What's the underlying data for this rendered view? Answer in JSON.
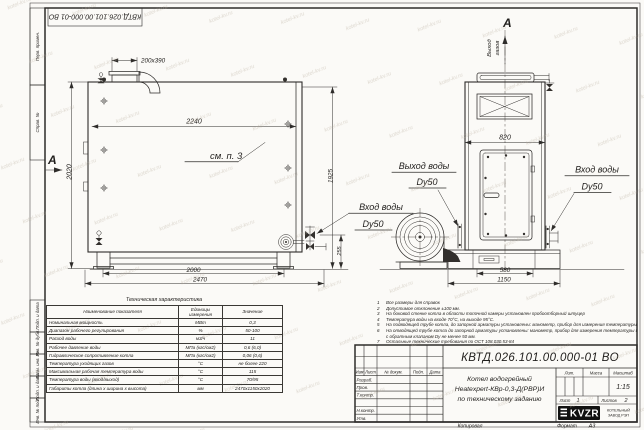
{
  "sheet": {
    "corner_stamp": "КВТД.026.101.00.000-01 ВО"
  },
  "watermark": "kotel-kv.ru",
  "margin_labels": [
    "Перв. примен.",
    "Справ. №",
    "Подп. и дата",
    "Инв. № дубл.",
    "Взам. инв. №",
    "Подп. и дата",
    "Инв. № подл."
  ],
  "drawing": {
    "left_view": {
      "section_label": "А",
      "see_note": "см. п. 3",
      "dim_flue": "200х390",
      "dim_top": "2240",
      "dim_height": "2020",
      "dim_height_right": "1925",
      "dim_fitting": "255",
      "dim_supports": "2000",
      "dim_length": "2470",
      "water_in_l1": "Вход воды",
      "water_in_l2": "Dу50"
    },
    "right_view": {
      "view_label": "А",
      "gas_l1": "Выход",
      "gas_l2": "газов",
      "dim_width": "820",
      "dim_base": "580",
      "dim_overall": "1150",
      "water_out_l1": "Выход воды",
      "water_out_l2": "Dу50",
      "water_in_l1": "Вход воды",
      "water_in_l2": "Dу50"
    }
  },
  "spec_table": {
    "title": "Техническая характеристика",
    "headers": [
      "Наименование показателя",
      "Единицы измерения",
      "Значение"
    ],
    "rows": [
      [
        "Номинальная мощность",
        "МВт",
        "0,3"
      ],
      [
        "Диапазон рабочего регулирования",
        "%",
        "50-100"
      ],
      [
        "Расход воды",
        "м3/ч",
        "11"
      ],
      [
        "Рабочее давление воды",
        "МПа (кгс/см2)",
        "0,6 (6,0)"
      ],
      [
        "Гидравлическое сопротивление котла",
        "МПа (кгс/см2)",
        "0,06 (0,6)"
      ],
      [
        "Температура уходящих газов",
        "°С",
        "не более 220"
      ],
      [
        "Максимальная рабочая температура воды",
        "°С",
        "115"
      ],
      [
        "Температура воды (вход/выход)",
        "°С",
        "70/95"
      ],
      [
        "Габариты котла (длина х ширина х высота)",
        "мм",
        "2470х1150х2020"
      ]
    ]
  },
  "notes": [
    {
      "n": "1",
      "t": "Все размеры для справок"
    },
    {
      "n": "2",
      "t": "Допустимое отклонение ±100 мм."
    },
    {
      "n": "3",
      "t": "На боковой стенке котла в области топочной камеры установлен пробоотборный штуцер"
    },
    {
      "n": "4",
      "t": "Температура воды на входе 70°С, на выходе 95°С."
    },
    {
      "n": "5",
      "t": "На подводящей трубе котла, до запорной арматуры установлены: манометр, прибор для измерения температуры."
    },
    {
      "n": "6",
      "t": "На отводящей трубе котла до запорной арматуры установлены: манометр, прибор для измерения температуры и обвод"
    },
    {
      "n": "",
      "t": "с обратным клапаном Dу не менее 50 мм."
    },
    {
      "n": "7",
      "t": "Остальные технические требования по ОСТ 108.030.53-84"
    }
  ],
  "title_block": {
    "doc_number": "КВТД.026.101.00.000-01 ВО",
    "columns": {
      "izm": "Изм",
      "list": "Лист",
      "doc": "№ докум.",
      "sign": "Подп.",
      "date": "Дата"
    },
    "rows": {
      "developed": "Разраб.",
      "checked": "Пров.",
      "tcontrol": "Т.контр.",
      "ncontrol": "Н.контр.",
      "approved": "Утв."
    },
    "product_lines": [
      "Котел водогрейный",
      "Heatexpert-КВр-0,3-Д(РВР)И",
      "по техническому заданию"
    ],
    "lit_label": "Лит.",
    "mass_label": "Масса",
    "scale_label": "Масштаб",
    "scale_value": "1:15",
    "sheet_label": "Лист",
    "sheet_value": "1",
    "sheets_label": "Листов",
    "sheets_value": "2",
    "company": {
      "logo": "KVZR",
      "line1": "КОТЕЛЬНЫЙ",
      "line2": "ЗАВОД РЭП"
    },
    "copied_label": "Копировал",
    "format_label": "Формат",
    "format_value": "А3"
  }
}
